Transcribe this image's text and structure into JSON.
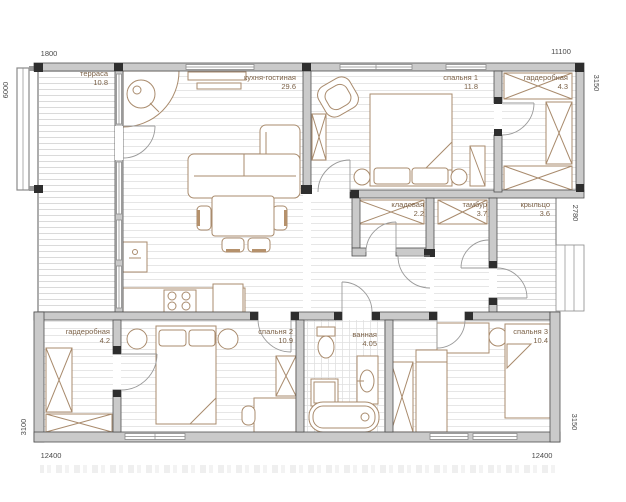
{
  "plan": {
    "rooms": [
      {
        "name": "терраса",
        "area": "10.8"
      },
      {
        "name": "кухня-гостиная",
        "area": "29.6"
      },
      {
        "name": "спальня 1",
        "area": "11.8"
      },
      {
        "name": "гардеробная",
        "area": "4.3"
      },
      {
        "name": "кладовая",
        "area": "2.2"
      },
      {
        "name": "тамбур",
        "area": "3.7"
      },
      {
        "name": "крыльцо",
        "area": "3.6"
      },
      {
        "name": "гардеробная",
        "area": "4.2"
      },
      {
        "name": "спальня 2",
        "area": "10.9"
      },
      {
        "name": "ванная",
        "area": "4.05"
      },
      {
        "name": "спальня 3",
        "area": "10.4"
      }
    ],
    "dimensions": {
      "terrace_width": "1800",
      "house_width": "11100",
      "left_height": "6000",
      "right_top_height": "3150",
      "porch_height": "2780",
      "right_bottom_height": "3150",
      "left_bottom_height": "3100",
      "bottom_width_left": "12400",
      "bottom_width_right": "12400"
    },
    "colors": {
      "wall": "#cacaca",
      "wall_outline": "#4f4f4f",
      "furniture_line": "#a98b6d",
      "label_text": "#7b6147",
      "dimension_text": "#4a4a4a",
      "floor_hatch": "#e6e6e6"
    }
  }
}
